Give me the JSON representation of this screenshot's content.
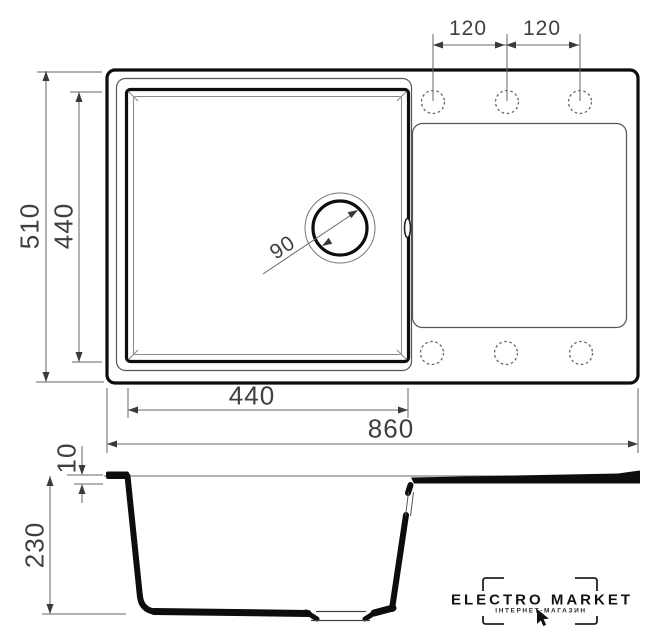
{
  "colors": {
    "ink": "#0d0d0d",
    "thin_line": "#666666",
    "dim_text": "#3f3f3f"
  },
  "plan_view": {
    "overall_width_mm": "860",
    "overall_depth_mm": "510",
    "bowl_width_mm": "440",
    "bowl_depth_mm": "440",
    "tap_hole_spacing_left_mm": "120",
    "tap_hole_spacing_right_mm": "120",
    "drain_diameter_mm": "90"
  },
  "side_view": {
    "bowl_depth_mm": "230",
    "rim_height_mm": "10"
  },
  "logo": {
    "brand": "ELECTRO MARKET",
    "tagline": "ІНТЕРНЕТ-МАГАЗИН"
  }
}
